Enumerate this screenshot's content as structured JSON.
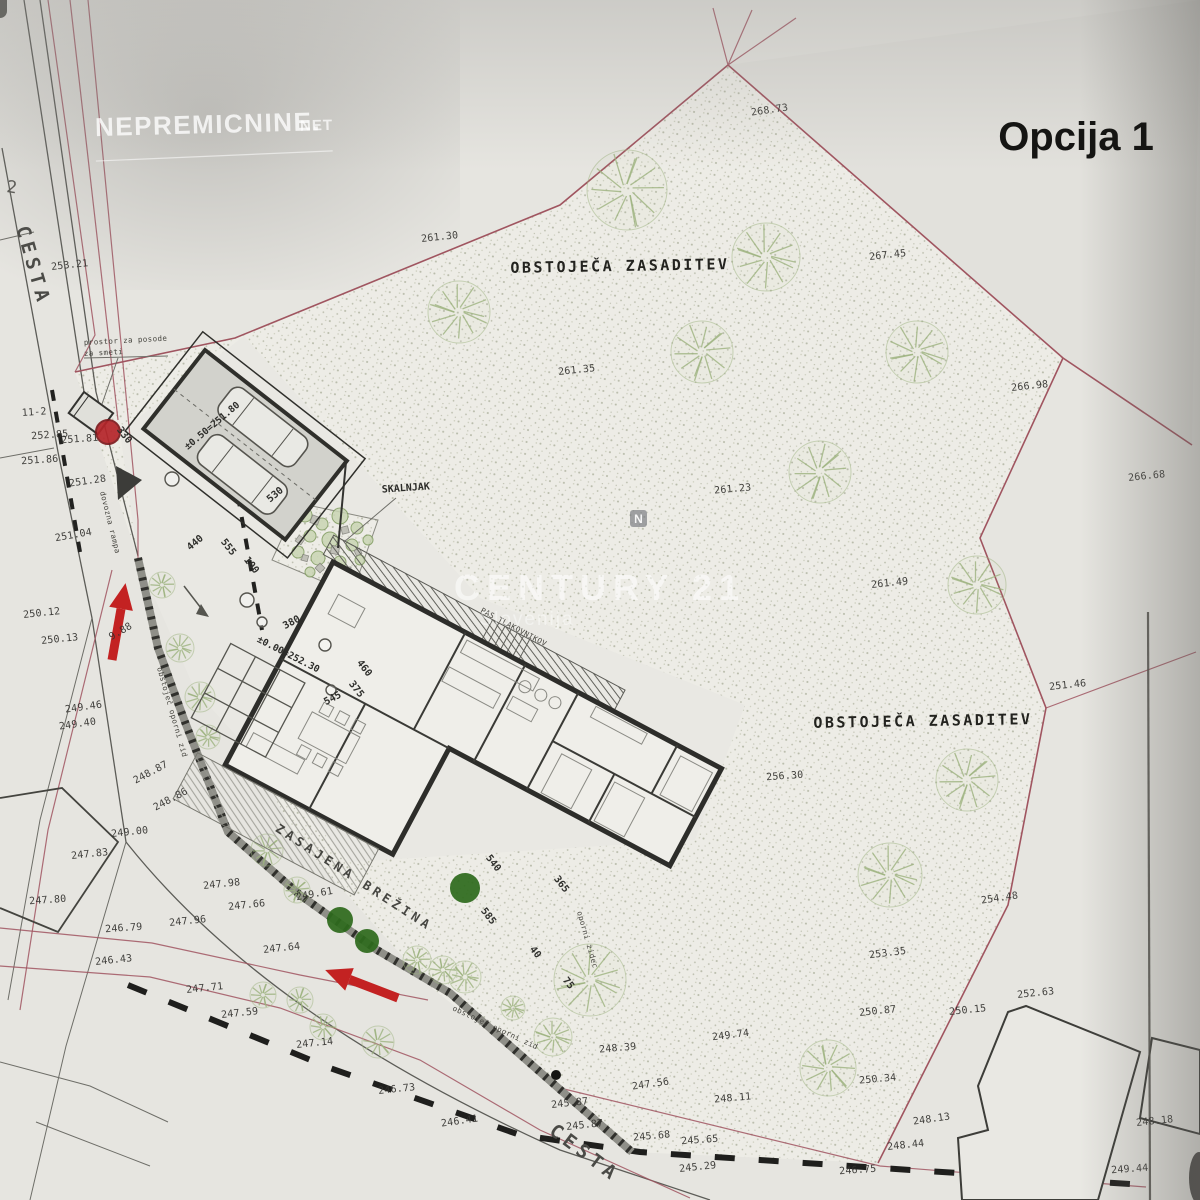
{
  "header": {
    "title": "Opcija 1"
  },
  "watermarks": {
    "portal": "NEPREMICNINE.",
    "portal_suffix": "NET",
    "agency": "CENTURY 21",
    "agency_sub": "Slovenija",
    "compass": "N"
  },
  "labels": {
    "existing_vegetation": "OBSTOJEČA ZASADITEV",
    "road": "CESTA",
    "rock_garden": "SKALNJAK",
    "planted_slope": "ZASAJENA BREŽINA",
    "waste_line1": "prostor za posode",
    "waste_line2": "za smeti",
    "retaining_wall": "obstoječ oporni zid",
    "ramp": "dovozna rampa",
    "pavers": "PAS TLAKOVNIKOV",
    "wall_small": "oporni zidec",
    "parcel_no": "11-2",
    "edge_digit": "2",
    "house_level": "±0.00=252.30",
    "garage_level": "±0.50=251.80"
  },
  "elevations": [
    [
      "268.73",
      770,
      113,
      -8
    ],
    [
      "261.30",
      440,
      240,
      -6
    ],
    [
      "267.45",
      888,
      258,
      -6
    ],
    [
      "261.35",
      577,
      373,
      -6
    ],
    [
      "266.98",
      1030,
      389,
      -6
    ],
    [
      "266.68",
      1147,
      479,
      -6
    ],
    [
      "261.23",
      733,
      492,
      -5
    ],
    [
      "261.49",
      890,
      586,
      -6
    ],
    [
      "251.46",
      1068,
      688,
      -6
    ],
    [
      "256.30",
      785,
      779,
      -4
    ],
    [
      "254.48",
      1000,
      901,
      -8
    ],
    [
      "253.35",
      888,
      956,
      -7
    ],
    [
      "250.87",
      878,
      1014,
      -6
    ],
    [
      "250.15",
      968,
      1013,
      -6
    ],
    [
      "252.63",
      1036,
      996,
      -6
    ],
    [
      "250.34",
      878,
      1082,
      -5
    ],
    [
      "248.13",
      932,
      1122,
      -8
    ],
    [
      "248.44",
      906,
      1148,
      -6
    ],
    [
      "246.75",
      858,
      1173,
      -4
    ],
    [
      "248.18",
      1155,
      1124,
      -6
    ],
    [
      "249.44",
      1130,
      1172,
      -4
    ],
    [
      "249.74",
      731,
      1038,
      -7
    ],
    [
      "248.39",
      618,
      1051,
      -5
    ],
    [
      "248.11",
      733,
      1101,
      -5
    ],
    [
      "247.56",
      651,
      1087,
      -8
    ],
    [
      "245.68",
      652,
      1139,
      -5
    ],
    [
      "245.65",
      700,
      1143,
      -4
    ],
    [
      "245.29",
      698,
      1170,
      -6
    ],
    [
      "245.87",
      570,
      1106,
      -6
    ],
    [
      "245.87",
      585,
      1128,
      -6
    ],
    [
      "246.41",
      460,
      1124,
      -8
    ],
    [
      "246.73",
      397,
      1092,
      -6
    ],
    [
      "247.14",
      315,
      1046,
      -6
    ],
    [
      "247.59",
      240,
      1016,
      -6
    ],
    [
      "247.71",
      205,
      991,
      -6
    ],
    [
      "246.43",
      114,
      963,
      -6
    ],
    [
      "246.79",
      124,
      931,
      -4
    ],
    [
      "247.96",
      188,
      924,
      -6
    ],
    [
      "247.66",
      247,
      908,
      -6
    ],
    [
      "247.98",
      222,
      887,
      -6
    ],
    [
      "249.00",
      130,
      835,
      -6
    ],
    [
      "249.61",
      315,
      897,
      -10
    ],
    [
      "247.64",
      282,
      951,
      -6
    ],
    [
      "247.83",
      90,
      857,
      -6
    ],
    [
      "247.80",
      48,
      903,
      -4
    ],
    [
      "248.87",
      152,
      775,
      -28
    ],
    [
      "248.86",
      172,
      802,
      -28
    ],
    [
      "249.46",
      84,
      710,
      -8
    ],
    [
      "249.40",
      78,
      727,
      -8
    ],
    [
      "250.12",
      42,
      616,
      -6
    ],
    [
      "250.13",
      60,
      642,
      -6
    ],
    [
      "9.88",
      122,
      634,
      -30
    ],
    [
      "251.04",
      74,
      538,
      -10
    ],
    [
      "251.86",
      40,
      463,
      -4
    ],
    [
      "252.85",
      50,
      438,
      -4
    ],
    [
      "251.81",
      80,
      442,
      -4
    ],
    [
      "251.28",
      88,
      484,
      -8
    ],
    [
      "253.21",
      70,
      268,
      -6
    ]
  ],
  "dimensions": [
    [
      "530",
      277,
      497,
      -40
    ],
    [
      "440",
      197,
      545,
      -40
    ],
    [
      "330",
      122,
      437,
      52
    ],
    [
      "555",
      226,
      549,
      52
    ],
    [
      "100",
      249,
      567,
      52
    ],
    [
      "380",
      293,
      625,
      -28
    ],
    [
      "460",
      362,
      670,
      52
    ],
    [
      "375",
      354,
      691,
      52
    ],
    [
      "545",
      334,
      701,
      -28
    ],
    [
      "540",
      491,
      865,
      52
    ],
    [
      "365",
      559,
      886,
      52
    ],
    [
      "585",
      486,
      918,
      52
    ],
    [
      "40",
      533,
      954,
      52
    ],
    [
      "75",
      566,
      985,
      52
    ]
  ],
  "trees": {
    "light": [
      [
        627,
        190,
        40
      ],
      [
        766,
        257,
        34
      ],
      [
        459,
        312,
        31
      ],
      [
        702,
        352,
        31
      ],
      [
        917,
        352,
        31
      ],
      [
        820,
        472,
        31
      ],
      [
        977,
        585,
        29
      ],
      [
        967,
        780,
        31
      ],
      [
        890,
        875,
        32
      ],
      [
        828,
        1068,
        28
      ],
      [
        553,
        1037,
        19
      ],
      [
        590,
        980,
        36
      ],
      [
        162,
        585,
        13
      ],
      [
        180,
        648,
        14
      ],
      [
        200,
        697,
        15
      ],
      [
        208,
        737,
        12
      ],
      [
        267,
        850,
        16
      ],
      [
        297,
        890,
        13
      ],
      [
        263,
        995,
        13
      ],
      [
        300,
        1000,
        13
      ],
      [
        323,
        1027,
        13
      ],
      [
        378,
        1042,
        16
      ],
      [
        417,
        960,
        14
      ],
      [
        443,
        970,
        14
      ],
      [
        465,
        977,
        16
      ],
      [
        513,
        1008,
        12
      ]
    ],
    "dark": [
      [
        465,
        888,
        15
      ],
      [
        340,
        920,
        13
      ],
      [
        367,
        941,
        12
      ]
    ]
  },
  "rock_garden": {
    "plants": [
      [
        305,
        515,
        7
      ],
      [
        322,
        524,
        6
      ],
      [
        340,
        516,
        8
      ],
      [
        357,
        528,
        6
      ],
      [
        310,
        536,
        6
      ],
      [
        330,
        540,
        8
      ],
      [
        352,
        545,
        6
      ],
      [
        368,
        540,
        5
      ],
      [
        298,
        552,
        6
      ],
      [
        318,
        558,
        7
      ],
      [
        340,
        562,
        6
      ],
      [
        360,
        560,
        5
      ],
      [
        330,
        578,
        6
      ],
      [
        310,
        572,
        5
      ]
    ],
    "stones": [
      [
        315,
        520,
        8,
        20
      ],
      [
        345,
        530,
        7,
        -15
      ],
      [
        300,
        540,
        7,
        35
      ],
      [
        335,
        550,
        8,
        10
      ],
      [
        358,
        552,
        6,
        -25
      ],
      [
        320,
        568,
        7,
        45
      ],
      [
        348,
        570,
        6,
        0
      ],
      [
        305,
        558,
        6,
        15
      ]
    ]
  },
  "manholes": [
    [
      172,
      479,
      7
    ],
    [
      247,
      600,
      7
    ],
    [
      262,
      622,
      5
    ],
    [
      325,
      645,
      6
    ],
    [
      331,
      690,
      5
    ]
  ],
  "colors": {
    "paper": "#e6e5e0",
    "stipple_dot": "#a6aa95",
    "boundary": "#a05560",
    "accent": "#c32222",
    "ink": "#2e2e2b",
    "tree": "#9db37f",
    "bush": "#2e6b1d"
  }
}
